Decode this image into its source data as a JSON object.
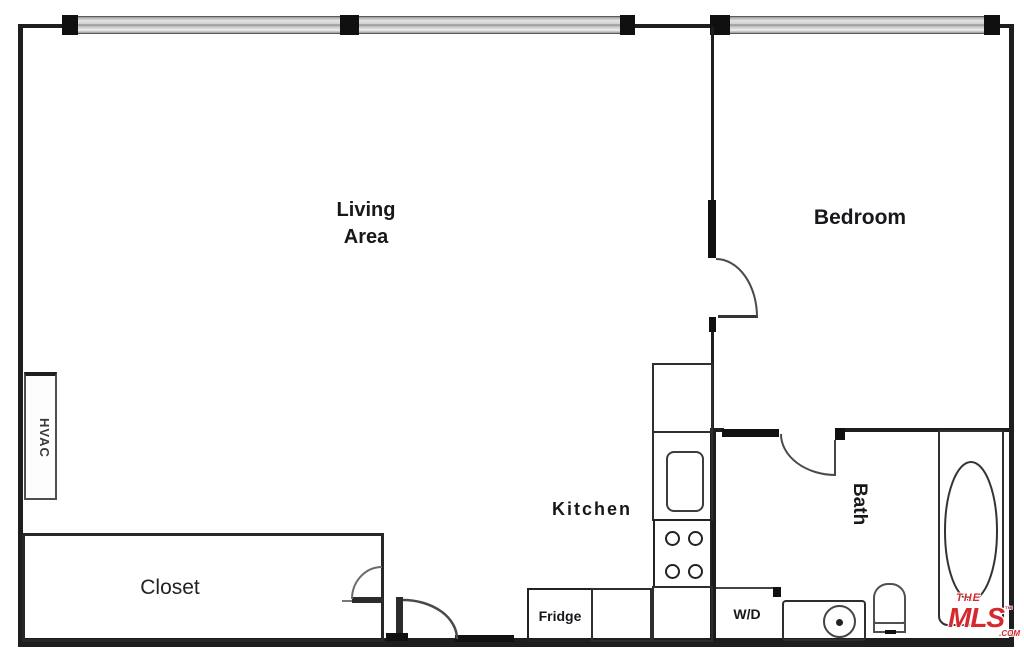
{
  "plan": {
    "labels": {
      "living_line1": "Living",
      "living_line2": "Area",
      "bedroom": "Bedroom",
      "kitchen": "Kitchen",
      "bath": "Bath",
      "closet": "Closet",
      "hvac": "HVAC",
      "fridge": "Fridge",
      "washer_dryer": "W/D"
    },
    "logo": {
      "the": "THE",
      "mls": "MLS",
      "tm": "™",
      "com": ".COM",
      "color": "#d7282e"
    },
    "colors": {
      "wall": "#1e1e1e",
      "label": "#17171c",
      "window_fill": "#d4d4d4",
      "logo_red": "#d7282e"
    }
  }
}
